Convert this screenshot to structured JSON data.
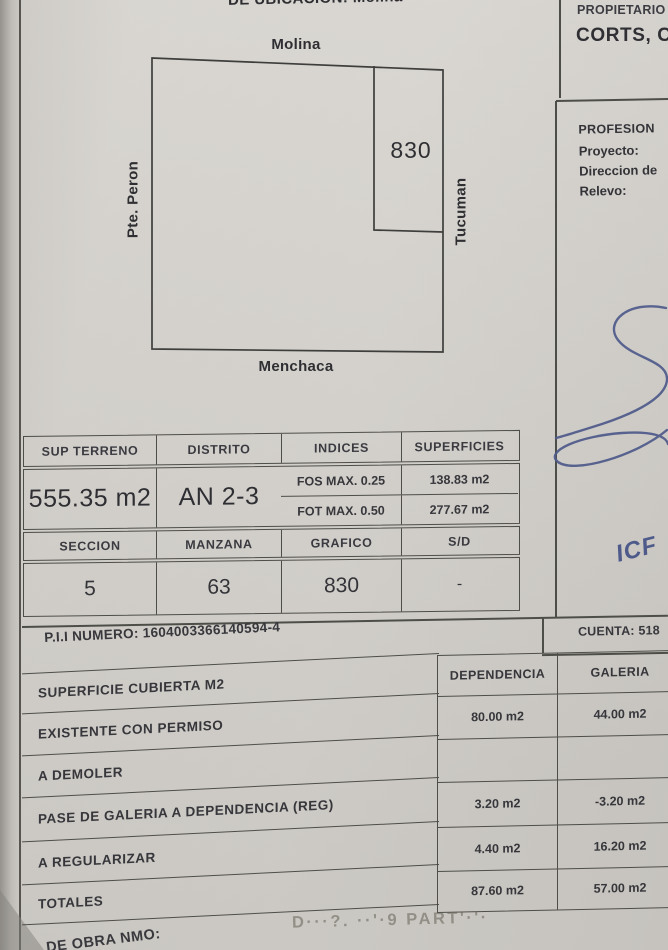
{
  "colors": {
    "paper": "#d5d2cd",
    "ink": "#333338",
    "line": "#4e4e49",
    "blue_ink": "#4e5a8a",
    "faded_stamp": "#8e8a80"
  },
  "header": {
    "location_line": "DE UBICACION: Molina",
    "propietario_label": "PROPIETARIO",
    "propietario_name": "CORTS, C"
  },
  "right_panel": {
    "profesion_heading": "PROFESION",
    "field_labels": [
      "Proyecto:",
      "Direccion de",
      "Relevo:"
    ],
    "handwritten_initials": "ICF",
    "cuenta_label": "CUENTA: 518"
  },
  "diagram": {
    "street_top": "Molina",
    "street_left": "Pte. Peron",
    "street_right": "Tucuman",
    "street_bottom": "Menchaca",
    "parcel_number": "830"
  },
  "table1": {
    "headers": [
      "SUP TERRENO",
      "DISTRITO",
      "INDICES",
      "SUPERFICIES"
    ],
    "sup_terreno": "555.35 m2",
    "distrito": "AN 2-3",
    "indices_rows": [
      {
        "label": "FOS MAX. 0.25",
        "value": "138.83 m2"
      },
      {
        "label": "FOT MAX. 0.50",
        "value": "277.67 m2"
      }
    ],
    "sub_headers": [
      "SECCION",
      "MANZANA",
      "GRAFICO",
      "S/D"
    ],
    "seccion": "5",
    "manzana": "63",
    "grafico": "830",
    "sd_value": "-"
  },
  "pii_line": "P.I.I NUMERO: 1604003366140594-4",
  "table2": {
    "title": "SUPERFICIE CUBIERTA M2",
    "col_dependencia": "DEPENDENCIA",
    "col_galeria": "GALERIA",
    "rows": [
      {
        "label": "EXISTENTE CON PERMISO",
        "dependencia": "80.00 m2",
        "galeria": "44.00 m2"
      },
      {
        "label": "A DEMOLER",
        "dependencia": "",
        "galeria": ""
      },
      {
        "label": "PASE DE GALERIA A DEPENDENCIA (REG)",
        "dependencia": "3.20 m2",
        "galeria": "-3.20 m2"
      },
      {
        "label": "A REGULARIZAR",
        "dependencia": "4.40 m2",
        "galeria": "16.20 m2"
      },
      {
        "label": "TOTALES",
        "dependencia": "87.60 m2",
        "galeria": "57.00 m2"
      }
    ]
  },
  "footer": {
    "obra_label": "DE OBRA NMO:",
    "stamp_text": "D···?. ··'·9 PART'·'·"
  }
}
